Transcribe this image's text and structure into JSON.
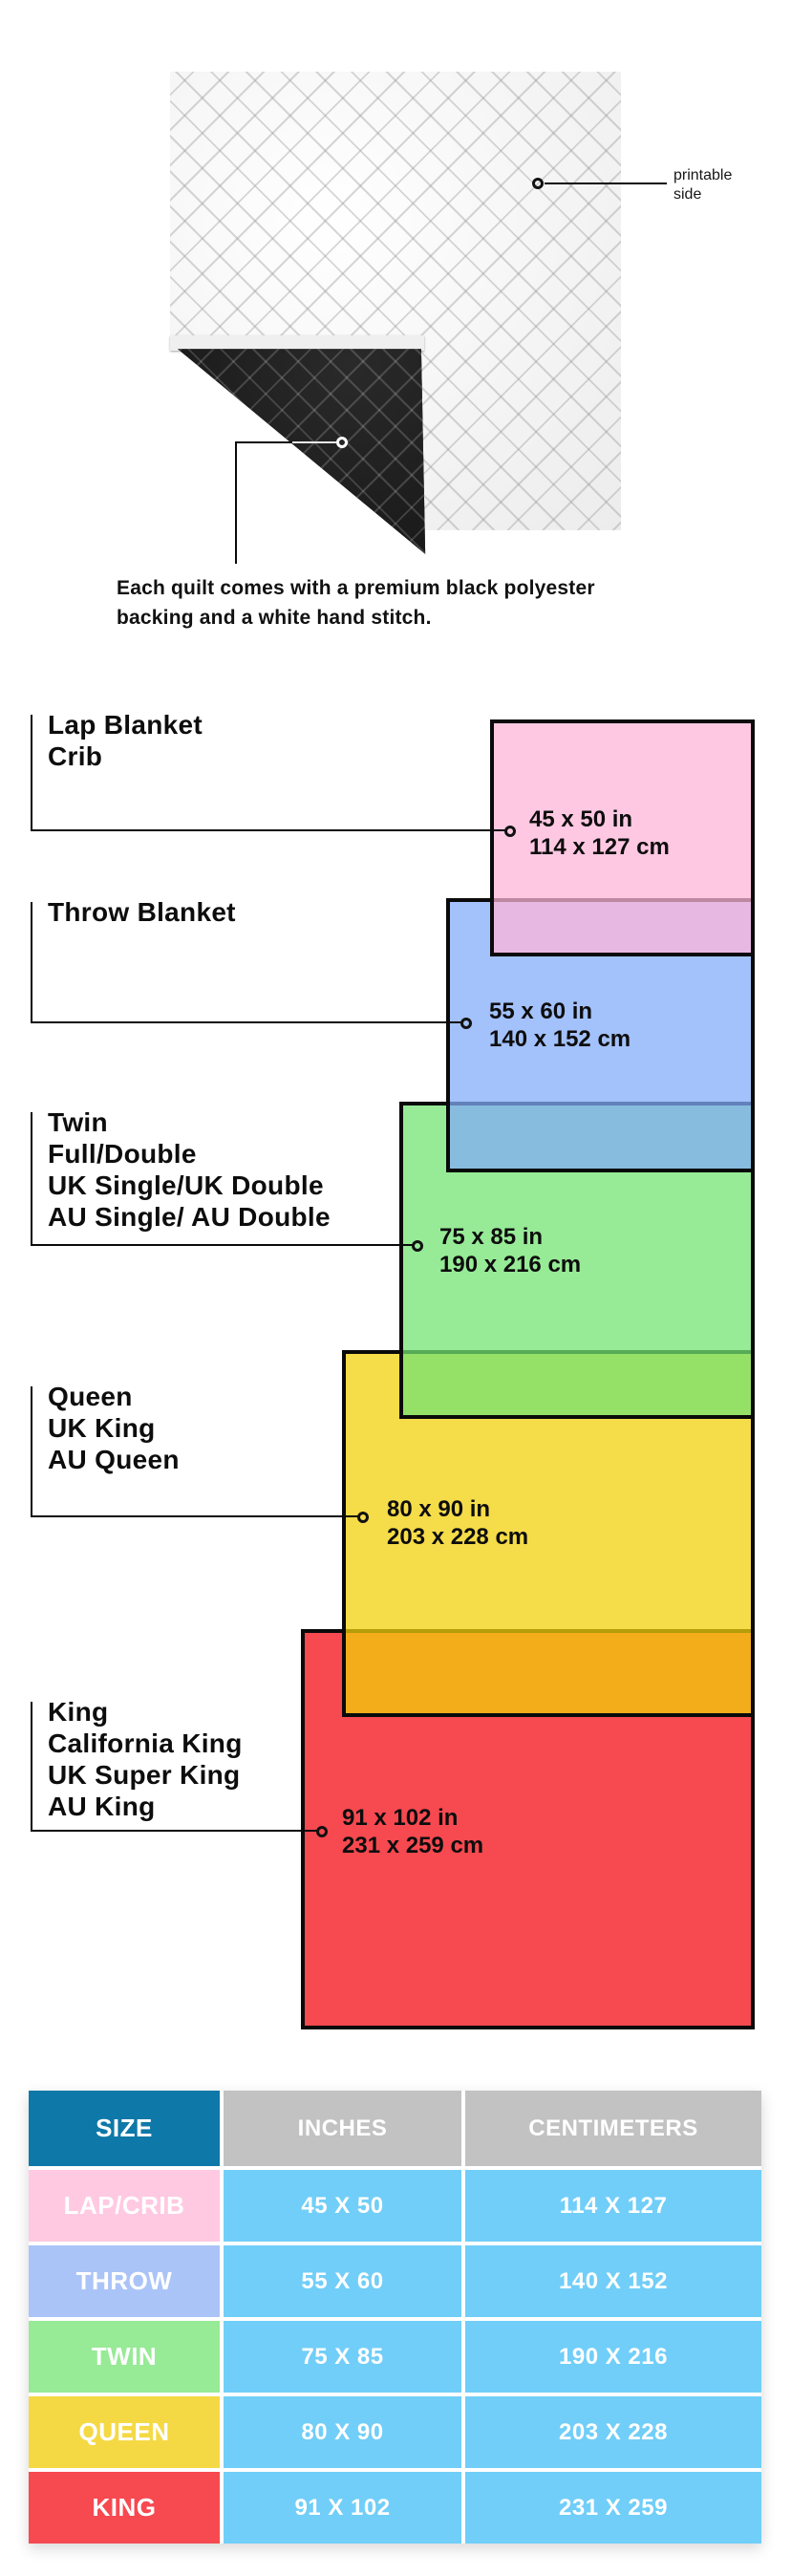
{
  "illustration": {
    "printable_label": "printable side",
    "caption_line1": "Each quilt comes with a premium black polyester",
    "caption_line2": "backing and a white hand stitch.",
    "colors": {
      "front": "#F6F6F6",
      "backing_black": "#161616"
    }
  },
  "diagram": {
    "groups": [
      {
        "lines": [
          "Lap Blanket",
          "Crib"
        ],
        "inches": "45 x 50 in",
        "cm": "114 x 127 cm",
        "color": "#FFC9E2"
      },
      {
        "lines": [
          "Throw Blanket"
        ],
        "inches": "55 x 60 in",
        "cm": "140 x 152 cm",
        "color": "#A3C1FA"
      },
      {
        "lines": [
          "Twin",
          "Full/Double",
          "UK Single/UK Double",
          "AU Single/ AU Double"
        ],
        "inches": "75 x 85 in",
        "cm": "190 x 216 cm",
        "color": "#97EA96"
      },
      {
        "lines": [
          "Queen",
          "UK King",
          "AU Queen"
        ],
        "inches": "80 x 90 in",
        "cm": "203 x 228 cm",
        "color": "#F5DC4A"
      },
      {
        "lines": [
          "King",
          "California King",
          "UK Super King",
          "AU King"
        ],
        "inches": "91 x 102 in",
        "cm": "231 x 259 cm",
        "color": "#F74950"
      }
    ],
    "overlap_colors": {
      "pink_over_blue": "#E2B5E2",
      "blue_over_green": "#88BAE2",
      "green_over_yellow": "#8FE064",
      "yellow_over_red": "#F5AF21"
    }
  },
  "table": {
    "headers": [
      "SIZE",
      "INCHES",
      "CENTIMETERS"
    ],
    "header_colors": {
      "size": "#0E78A8",
      "others": "#C2C2C2"
    },
    "cell_color": "#71CEF8",
    "rows": [
      {
        "size": "LAP/CRIB",
        "inches": "45 X 50",
        "cm": "114 X 127",
        "color": "#FFC9E2"
      },
      {
        "size": "THROW",
        "inches": "55 X 60",
        "cm": "140 X 152",
        "color": "#ABC4F8"
      },
      {
        "size": "TWIN",
        "inches": "75 X 85",
        "cm": "190 X 216",
        "color": "#97EA96"
      },
      {
        "size": "QUEEN",
        "inches": "80 X 90",
        "cm": "203 X 228",
        "color": "#F5D944"
      },
      {
        "size": "KING",
        "inches": "91 X 102",
        "cm": "231 X 259",
        "color": "#F64950"
      }
    ]
  }
}
